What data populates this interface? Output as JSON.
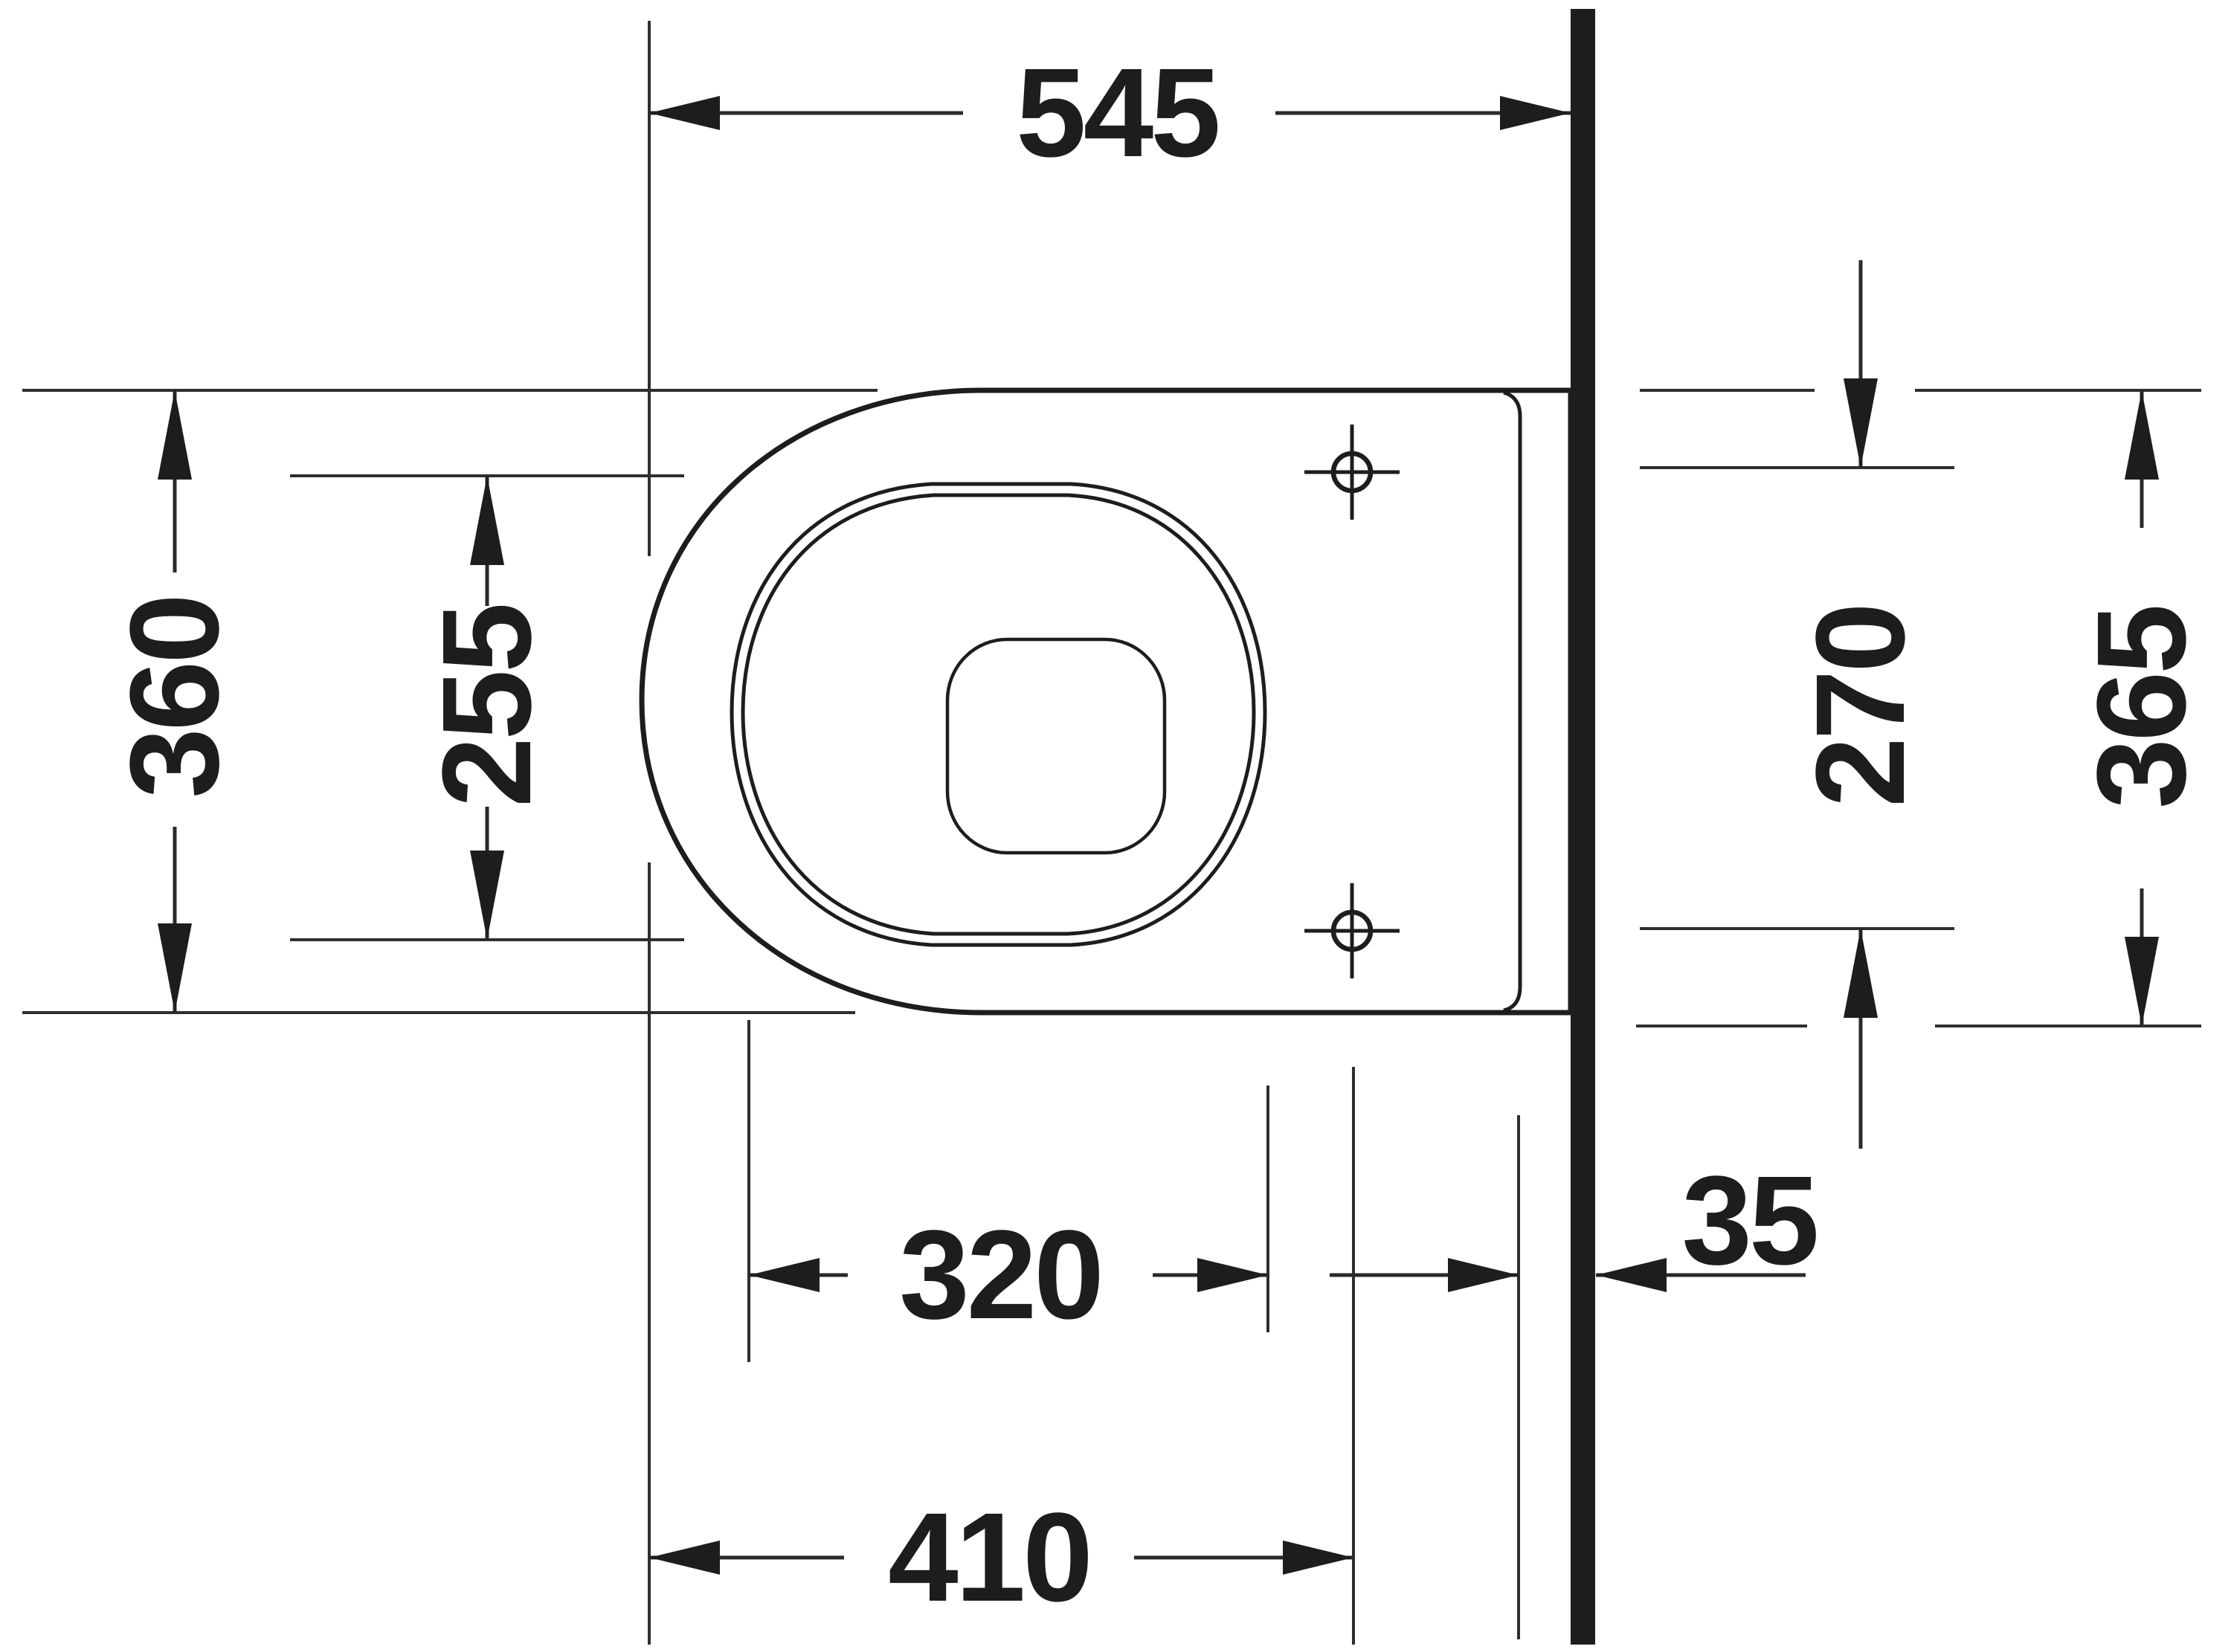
{
  "drawing": {
    "type": "technical-dimension-drawing",
    "subject": "wall-hung toilet, plan view",
    "ink_color": "#1d1d1b",
    "background_color": "#ffffff",
    "units": "mm",
    "dimensions": {
      "overall_depth": "545",
      "bowl_width": "360",
      "opening_width": "255",
      "opening_length": "320",
      "fixing_hole_spacing": "270",
      "width_at_wall": "365",
      "wall_offset": "35",
      "fixing_hole_distance": "410"
    }
  }
}
